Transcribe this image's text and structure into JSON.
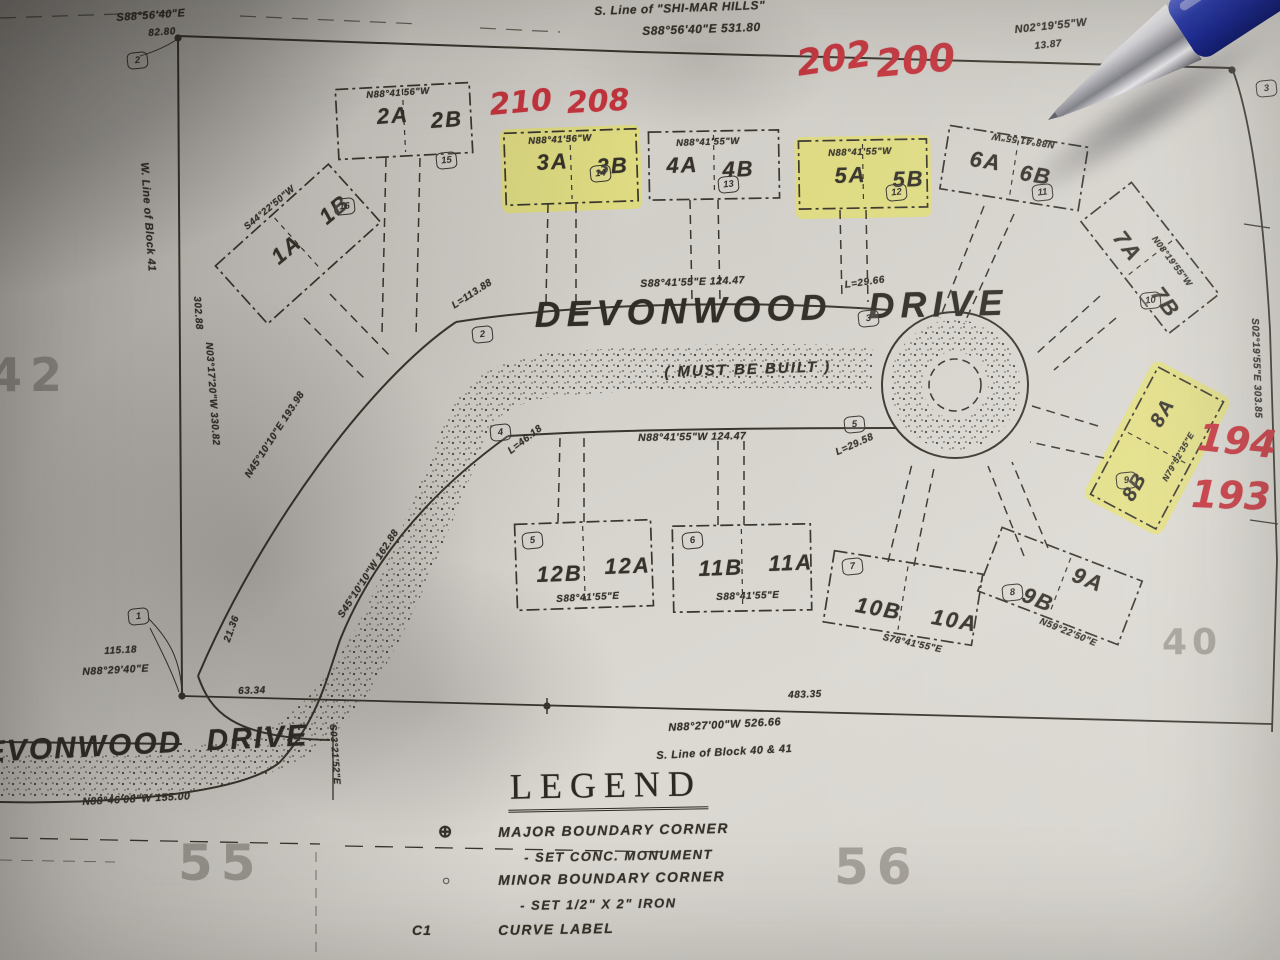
{
  "photo": {
    "paper_color": "#d6d3cd",
    "ink_color": "#37332c",
    "highlight_color": "#e9e63a",
    "red_marker_color": "#c8353e",
    "pen_barrel_color": "#2e3fae",
    "pen_tip_color": "#b9b9bf"
  },
  "streets": {
    "main_name": "DEVONWOOD DRIVE",
    "main_note": "( MUST BE BUILT )",
    "bottom_name": "EVONWOOD DRIVE"
  },
  "plat": {
    "shi_mar_line": "S. Line of \"SHI-MAR HILLS\"",
    "top_bearing": "S88°56'40\"E   531.80",
    "topleft_bearing": "S88°56'40\"E",
    "topleft_dist": "82.80",
    "ne_bearing": "N02°19'55\"W",
    "ne_dist": "13.87",
    "west_line_label": "W. Line of Block 41",
    "west_dist": "302.88",
    "west_bearing": "N03°17'20\"W  330.82",
    "right_bearing": "S02°19'55\"E  303.85",
    "road_top_bearing": "S88°41'55\"E  124.47",
    "road_bottom_bearing": "N88°41'55\"W  124.47",
    "curve_l_113_88": "L=113.88",
    "curve_l_29_66": "L=29.66",
    "curve_l_46_18": "L=46.18",
    "curve_l_29_58": "L=29.58",
    "diag_bearing_ne": "N45°10'10\"E  193.98",
    "diag_bearing_sw": "S45°10'10\"W  162.88",
    "dist_21_36": "21.36",
    "dist_63_34": "63.34",
    "dist_115_18": "115.18",
    "bearing_n88_29_40": "N88°29'40\"E",
    "bearing_s03_21_52": "S03°21'52\"E",
    "dist_483_35": "483.35",
    "south_line_bearing": "N88°27'00\"W  526.66",
    "south_line_label": "S. Line of Block 40 & 41",
    "bottom_road_bearing": "N88°46'08\"W  155.00"
  },
  "lots": {
    "lot1": {
      "a": "1A",
      "b": "1B",
      "bearing": "S44°22'50\"W",
      "corner": "16"
    },
    "lot2": {
      "a": "2A",
      "b": "2B",
      "bearing": "N88°41'56\"W",
      "corner": "15"
    },
    "lot3": {
      "a": "3A",
      "b": "3B",
      "bearing": "N88°41'56\"W",
      "corner": "14"
    },
    "lot4": {
      "a": "4A",
      "b": "4B",
      "bearing": "N88°41'55\"W",
      "corner": "13"
    },
    "lot5": {
      "a": "5A",
      "b": "5B",
      "bearing": "N88°41'55\"W",
      "corner": "12"
    },
    "lot6": {
      "a": "6A",
      "b": "6B",
      "bearing": "N88°41'55\"W",
      "corner": "11"
    },
    "lot7": {
      "a": "7A",
      "b": "7B",
      "bearing": "N08°19'55\"W",
      "corner": "10"
    },
    "lot8": {
      "a": "8A",
      "b": "8B",
      "bearing": "N79°52'35\"E",
      "corner": "9"
    },
    "lot9": {
      "a": "9A",
      "b": "9B",
      "bearing": "N59°22'50\"E",
      "corner": "8"
    },
    "lot10": {
      "a": "10A",
      "b": "10B",
      "bearing": "S78°41'55\"E",
      "corner": "7"
    },
    "lot11": {
      "a": "11A",
      "b": "11B",
      "bearing": "S88°41'55\"E",
      "corner": "6"
    },
    "lot12": {
      "a": "12A",
      "b": "12B",
      "bearing": "S88°41'55\"E",
      "corner": "5"
    }
  },
  "corners": {
    "c1": "1",
    "c2": "2",
    "c2_road": "2",
    "c3_road": "3",
    "c4_road": "4",
    "c5_road": "5",
    "c3_edge": "3"
  },
  "red_notes": {
    "n210": "210",
    "n208": "208",
    "n202": "202",
    "n200": "200",
    "n194": "194",
    "n193": "193"
  },
  "faint_block_numbers": {
    "n55": "55",
    "n56": "56",
    "n40": "40",
    "n42": "42"
  },
  "legend": {
    "title": "LEGEND",
    "items": [
      {
        "symbol": "⊕",
        "label": "MAJOR BOUNDARY CORNER",
        "sub": "- SET CONC. MONUMENT"
      },
      {
        "symbol": "○",
        "label": "MINOR BOUNDARY CORNER",
        "sub": "- SET 1/2\" X 2\" IRON"
      },
      {
        "symbol": "C1",
        "label": "CURVE LABEL",
        "sub": ""
      }
    ]
  }
}
